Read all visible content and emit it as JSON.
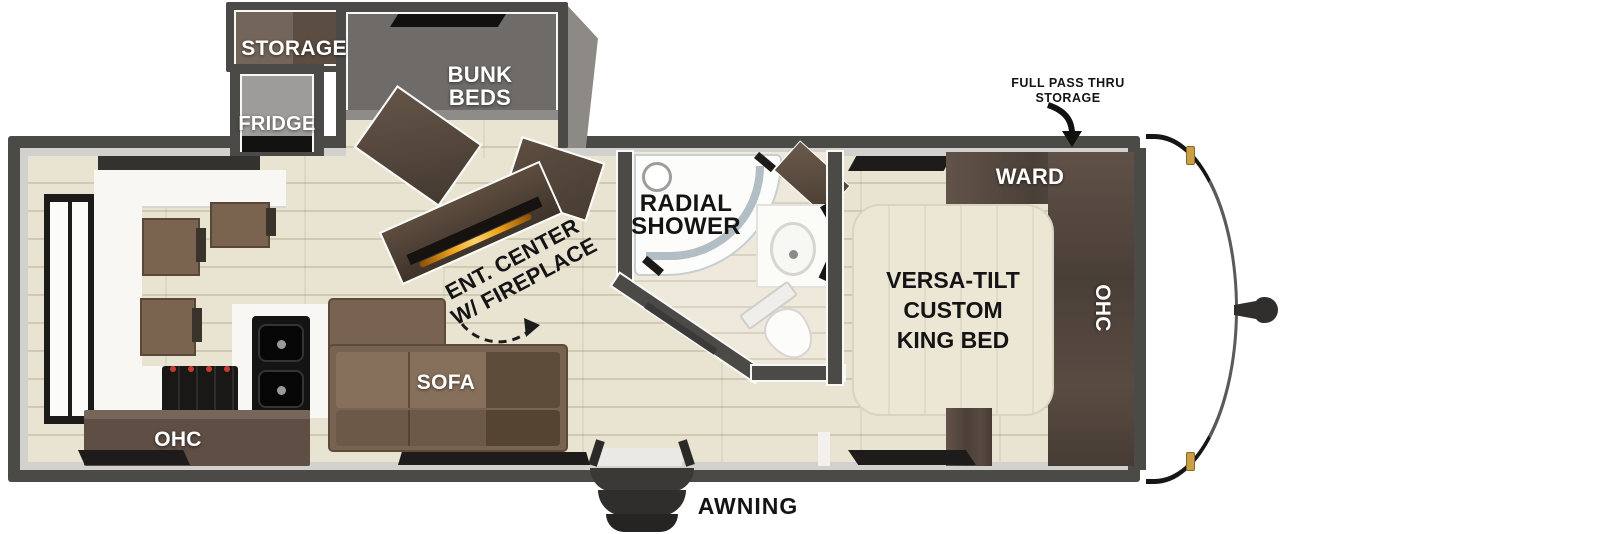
{
  "floorplan": {
    "exterior": {
      "pass_thru_lines": [
        "FULL PASS THRU",
        "STORAGE"
      ],
      "awning_label": "AWNING"
    },
    "compartments": {
      "storage_label": "STORAGE",
      "bunk_lines": [
        "BUNK",
        "BEDS"
      ],
      "fridge_label": "FRIDGE"
    },
    "kitchen": {
      "ohc_label": "OHC"
    },
    "living": {
      "sofa_label": "SOFA",
      "ent_center_lines": [
        "ENT. CENTER",
        "W/ FIREPLACE"
      ]
    },
    "bathroom": {
      "shower_lines": [
        "RADIAL",
        "SHOWER"
      ]
    },
    "bedroom": {
      "ward_label": "WARD",
      "ohc_label": "OHC",
      "bed_lines": [
        "VERSA-TILT",
        "CUSTOM",
        "KING BED"
      ]
    },
    "colors": {
      "wall": "#4b4a47",
      "floor": "#e9e3d1",
      "wood_dark": "#5a4a3d",
      "sofa": "#786250",
      "bed": "#ece7d5",
      "fireplace_glow": "#e08a12",
      "marker_light": "#cb9f46"
    }
  }
}
